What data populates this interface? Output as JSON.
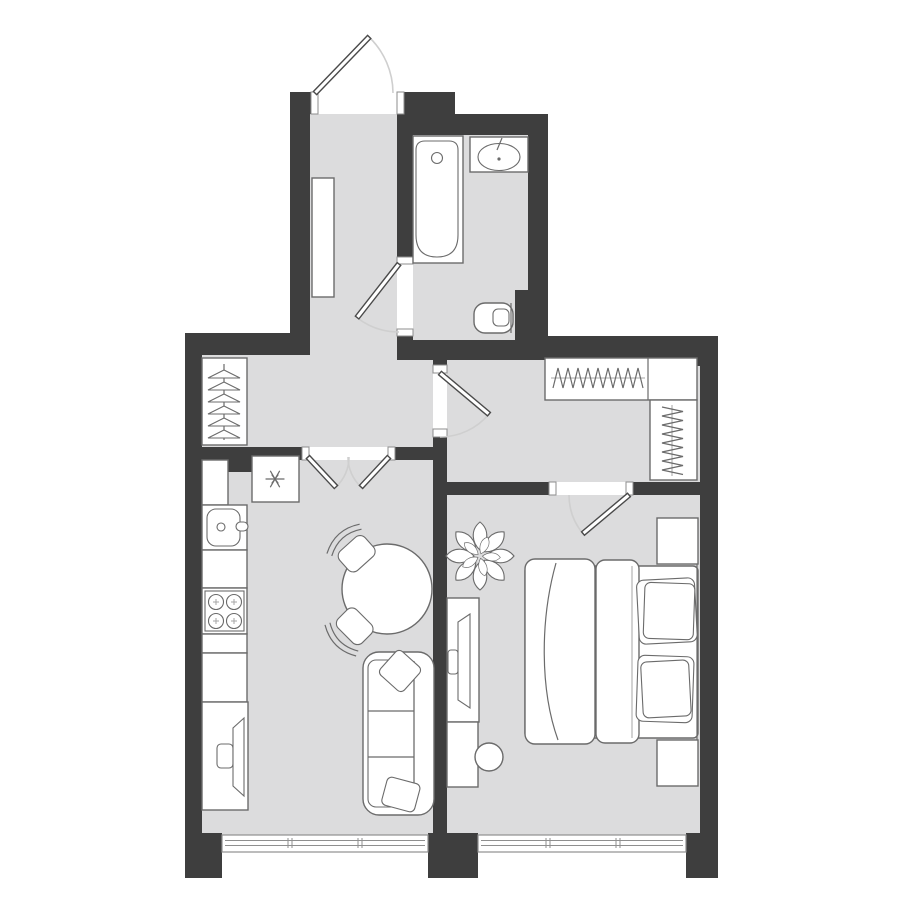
{
  "colors": {
    "background": "#ffffff",
    "wall": "#3e3e3e",
    "floor": "#dcdcdd",
    "furniture": "#ffffff",
    "outline": "#6b6b6b",
    "outline_light": "#a5a5a5",
    "door_arc": "#cfcfcf",
    "window": "#8f8f8f"
  },
  "plan": {
    "type": "apartment-floor-plan",
    "rooms": [
      {
        "name": "hallway",
        "symbols": [
          "entry-door",
          "coat-rack-with-hangers",
          "hall-cabinet",
          "double-door-to-living-room"
        ]
      },
      {
        "name": "bathroom",
        "symbols": [
          "bathroom-door",
          "bathtub",
          "sink-vanity",
          "toilet"
        ]
      },
      {
        "name": "kitchen-living-room",
        "symbols": [
          "fridge",
          "kitchen-counter",
          "kitchen-sink",
          "stove-4-burners",
          "tv-stand",
          "tv",
          "dining-table-round",
          "chair",
          "chair",
          "sofa-3-seat",
          "sofa-pillow",
          "sofa-pillow",
          "window-3-pane"
        ]
      },
      {
        "name": "walk-through-closet",
        "symbols": [
          "closet-door",
          "wardrobe-top-with-hangers",
          "wardrobe-side-with-hangers"
        ]
      },
      {
        "name": "bedroom",
        "symbols": [
          "bedroom-door",
          "plant",
          "desk",
          "monitor",
          "desk-cabinet",
          "stool",
          "double-bed",
          "blanket",
          "duvet",
          "pillow",
          "pillow",
          "nightstand",
          "nightstand",
          "window-3-pane"
        ]
      }
    ],
    "counts": {
      "doors": 5,
      "windows": 2,
      "rooms": 5
    }
  }
}
